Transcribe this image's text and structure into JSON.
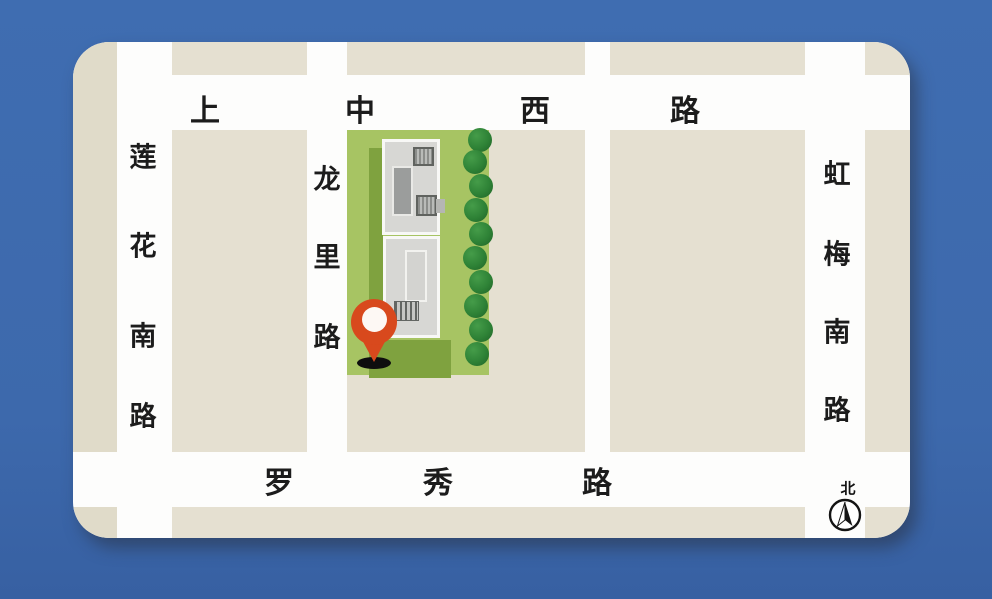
{
  "map": {
    "roads": {
      "top": {
        "name": "上中西路",
        "chars": [
          "上",
          "中",
          "西",
          "路"
        ]
      },
      "left": {
        "name": "莲花南路",
        "chars": [
          "莲",
          "花",
          "南",
          "路"
        ]
      },
      "middle": {
        "name": "龙里路",
        "chars": [
          "龙",
          "里",
          "路"
        ]
      },
      "right": {
        "name": "虹梅南路",
        "chars": [
          "虹",
          "梅",
          "南",
          "路"
        ]
      },
      "bottom": {
        "name": "罗秀路",
        "chars": [
          "罗",
          "秀",
          "路"
        ]
      }
    },
    "compass": {
      "north_label": "北"
    },
    "landmark": {
      "type": "building-with-pin"
    },
    "colors": {
      "background": "#3d6aae",
      "street": "#fdfdfc",
      "city_block": "#e5e0d1",
      "green_area": "#a7c463",
      "green_shadow": "#7fa23f",
      "tree": "#2e8236",
      "building": "#d7d7d4",
      "pin": "#d8491d"
    }
  }
}
